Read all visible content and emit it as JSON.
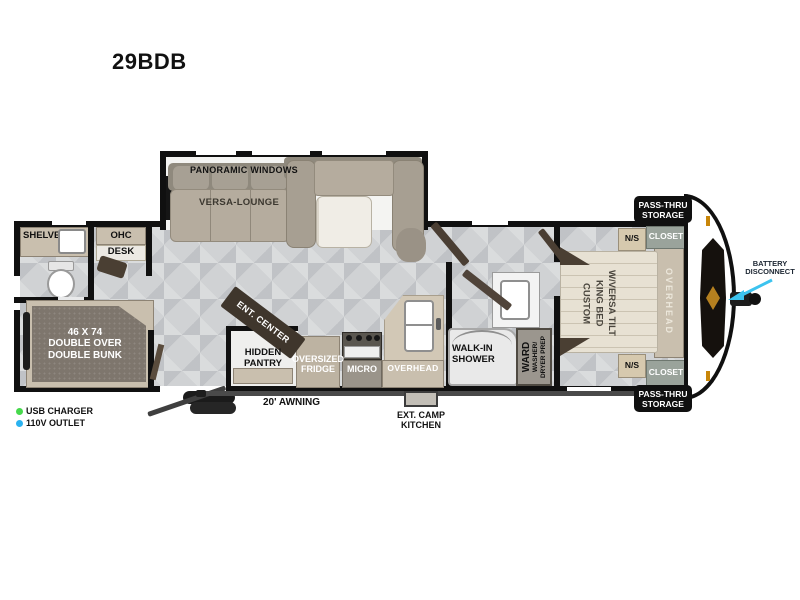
{
  "title": "29BDB",
  "colors": {
    "wall": "#101010",
    "floor_tile": "#d0d2d4",
    "cabinet_tan": "#c9bfae",
    "dark_wood": "#4a3f33",
    "arrow_cyan": "#3cc3ef",
    "usb_dot_green": "#46d94c",
    "outlet_dot_blue": "#2ab2f0"
  },
  "legend": {
    "usb": "USB CHARGER",
    "outlet": "110V OUTLET"
  },
  "rear_room": {
    "shelves": "SHELVES",
    "ohc": "OHC",
    "desk": "DESK",
    "bunk": "46 X 74\nDOUBLE OVER\nDOUBLE BUNK"
  },
  "living": {
    "panoramic_windows": "PANORAMIC WINDOWS",
    "versa_lounge": "VERSA-LOUNGE",
    "ent_center": "ENT. CENTER"
  },
  "kitchen": {
    "hidden_pantry": "HIDDEN\nPANTRY",
    "fridge": "OVERSIZED\nFRIDGE",
    "micro": "MICRO",
    "overhead": "OVERHEAD"
  },
  "bath": {
    "shower": "WALK-IN\nSHOWER",
    "ward": "WARD",
    "washer": "WASHER/\nDRYER PREP"
  },
  "bedroom": {
    "bed_lines": [
      "CUSTOM",
      "KING BED",
      "W/VERSA TILT"
    ],
    "ns_top": "N/S",
    "ns_bottom": "N/S",
    "closet_top": "CLOSET",
    "closet_bottom": "CLOSET",
    "overhead": "OVERHEAD",
    "pass_thru_top": "PASS-THRU\nSTORAGE",
    "pass_thru_bottom": "PASS-THRU\nSTORAGE"
  },
  "exterior": {
    "awning": "20' AWNING",
    "camp_kitchen": "EXT. CAMP\nKITCHEN",
    "battery": "BATTERY\nDISCONNECT"
  }
}
